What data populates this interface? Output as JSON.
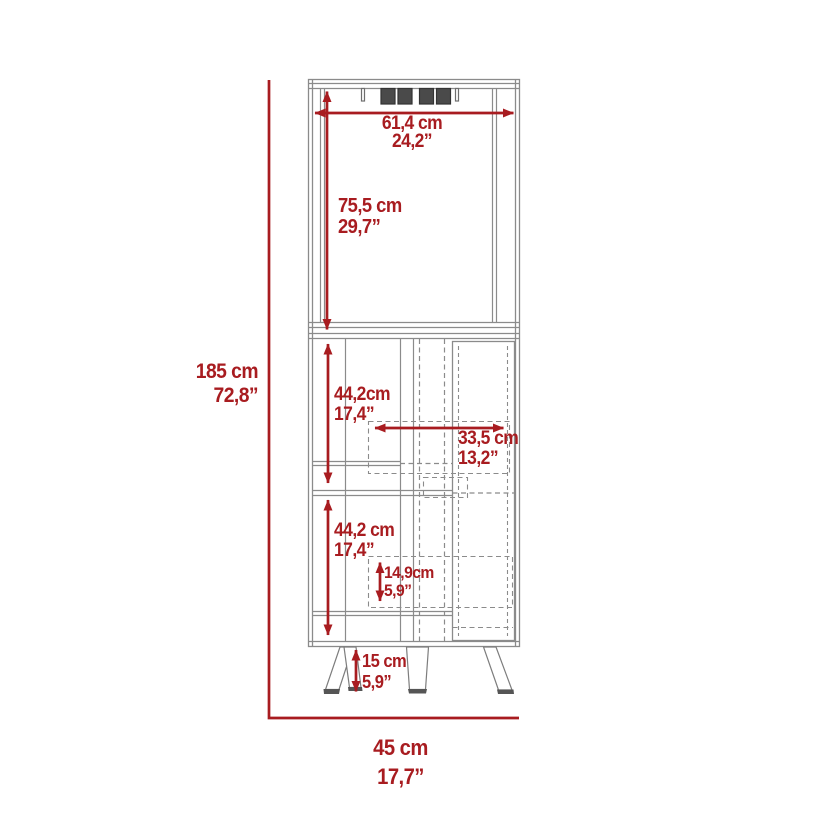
{
  "diagram_title": "corner-bar-cabinet-dimension-diagram",
  "colors": {
    "dimension_red": "#a81c20",
    "line_gray": "#8b8b8b",
    "slot_dark": "#4a4a4a"
  },
  "dimensions": {
    "overall_height": {
      "cm": "185 cm",
      "in": "72,8”"
    },
    "overall_depth": {
      "cm": "45 cm",
      "in": "17,7”"
    },
    "top_width": {
      "cm": "61,4 cm",
      "in": "24,2”"
    },
    "hutch_height": {
      "cm": "75,5 cm",
      "in": "29,7”"
    },
    "upper_section_height": {
      "cm": "44,2cm",
      "in": "17,4”"
    },
    "interior_shelf_width": {
      "cm": "33,5 cm",
      "in": "13,2”"
    },
    "lower_section_height": {
      "cm": "44,2 cm",
      "in": "17,4”"
    },
    "shelf_clearance": {
      "cm": "14,9cm",
      "in": "5,9”"
    },
    "leg_height": {
      "cm": "15 cm",
      "in": "5,9”"
    }
  }
}
